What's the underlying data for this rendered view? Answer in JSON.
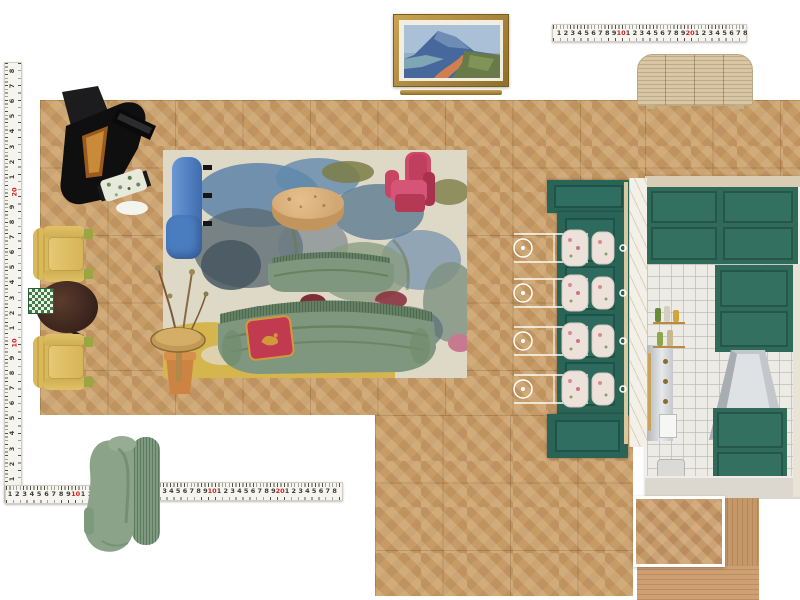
{
  "canvas": {
    "width": 800,
    "height": 600,
    "background": "#ffffff"
  },
  "board_type": "interior-design-moodboard-floorplan",
  "colors": {
    "floor": "#c69b66",
    "floor_line": "#7a552d",
    "teal_island": "#2a6457",
    "kitchen_green": "#2f6b58",
    "tile_white": "#edebe5",
    "stainless": "#c9ccd0",
    "rug_base": "#ded9c6",
    "rug_blue": "#5e82a8",
    "rug_slate": "#5c6b74",
    "rug_olive": "#7c7c46",
    "rug_yellow": "#d4b347",
    "rug_red": "#7c2f38",
    "sofa_green": "#7f977e",
    "sofa_fringe": "#5c785e",
    "pillow_red": "#c23a50",
    "pillow_gold": "#d09a3c",
    "blue_chair": "#4a7cc0",
    "pink_chair": "#c84262",
    "yellow_chair": "#d9b95c",
    "burl_table": "#d2a772",
    "brass": "#c09a56",
    "terracotta": "#cd8443",
    "piano_black": "#0f0f10",
    "sideboard_oak": "#d9c6a4",
    "frame_gold": "#b9934a",
    "ruler_bg": "#f6f4ef",
    "ruler_red": "#cc2020",
    "wood_swatch": "#c49868",
    "accent_chair_green": "#8ba388"
  },
  "rulers": {
    "top": {
      "orientation": "horizontal",
      "spacing": 6.9,
      "offset": 6,
      "numbers": [
        "1",
        "2",
        "3",
        "4",
        "5",
        "6",
        "7",
        "8",
        "9",
        "10",
        "1",
        "2",
        "3",
        "4",
        "5",
        "6",
        "7",
        "8",
        "9",
        "20",
        "1",
        "2",
        "3",
        "4",
        "5",
        "6",
        "7",
        "8"
      ],
      "red": [
        "10",
        "20"
      ]
    },
    "left": {
      "orientation": "vertical",
      "spacing": 15.1,
      "offset": 8,
      "numbers": [
        "8",
        "7",
        "6",
        "5",
        "4",
        "3",
        "2",
        "1",
        "20",
        "9",
        "8",
        "7",
        "6",
        "5",
        "4",
        "3",
        "2",
        "1",
        "10",
        "9",
        "8",
        "7",
        "6",
        "5",
        "4",
        "3",
        "2",
        "1",
        "20"
      ],
      "red": [
        "10",
        "20"
      ]
    },
    "bottom_left": {
      "orientation": "horizontal",
      "spacing": 7.3,
      "offset": 4,
      "numbers": [
        "1",
        "2",
        "3",
        "4",
        "5",
        "6",
        "7",
        "8",
        "9",
        "10",
        "1",
        "2",
        "3",
        "4",
        "5",
        "6",
        "7",
        "8",
        "9"
      ],
      "red": [
        "10"
      ]
    },
    "bottom_right": {
      "orientation": "horizontal",
      "spacing": 6.8,
      "offset": 5,
      "numbers": [
        "1",
        "2",
        "3",
        "4",
        "5",
        "6",
        "7",
        "8",
        "9",
        "10",
        "1",
        "2",
        "3",
        "4",
        "5",
        "6",
        "7",
        "8",
        "9",
        "20",
        "1",
        "2",
        "3",
        "4",
        "5",
        "6",
        "7",
        "8"
      ],
      "red": [
        "10",
        "20"
      ]
    }
  },
  "items": [
    {
      "name": "framed-landscape-painting",
      "description": "gold framed coastal mountain landscape with ledge below"
    },
    {
      "name": "reeded-oak-sideboard",
      "description": "light oak fluted credenza with rounded corners"
    },
    {
      "name": "grand-piano",
      "description": "black grand piano, open lid, floral bench"
    },
    {
      "name": "abstract-floral-rug",
      "description": "cream rug with blue, slate, olive, red florals and yellow band"
    },
    {
      "name": "blue-armchair",
      "description": "blue velvet chair, top view"
    },
    {
      "name": "burl-drum-coffee-table",
      "description": "round burl wood drum table"
    },
    {
      "name": "pink-sculptural-armchair",
      "description": "magenta curved armchair"
    },
    {
      "name": "green-curved-sofa-small",
      "description": "sage fringe-back loveseat, top view"
    },
    {
      "name": "green-curved-sofa-large",
      "description": "sage fringe-back curved sofa, top view"
    },
    {
      "name": "red-gold-pillow",
      "description": "crimson pillow with gold trim and motif"
    },
    {
      "name": "dried-branch-plant-terracotta-pot",
      "description": "dried arrangement in terracotta pot"
    },
    {
      "name": "brass-martini-side-table",
      "description": "round brass pedestal side table"
    },
    {
      "name": "yellow-armchair-pair",
      "description": "two striped yellow armchairs, top view"
    },
    {
      "name": "dark-round-game-table",
      "description": "dark wood pedestal table with chessboard"
    },
    {
      "name": "teal-kitchen-island",
      "description": "teal paneled island with marble counter edge"
    },
    {
      "name": "white-metal-bar-stools",
      "description": "four wire-frame stools with floral cushions"
    },
    {
      "name": "kitchen-elevation-photo",
      "description": "green cabinets, white square tile, steel hood, range, brass shelf"
    },
    {
      "name": "wood-flooring-swatches",
      "description": "herringbone sample with white border and plank samples"
    },
    {
      "name": "sage-accent-chair",
      "description": "sage green sculptural chair with fringe, product photo"
    },
    {
      "name": "tape-measures",
      "description": "four tape-measure rulers around the board"
    }
  ]
}
